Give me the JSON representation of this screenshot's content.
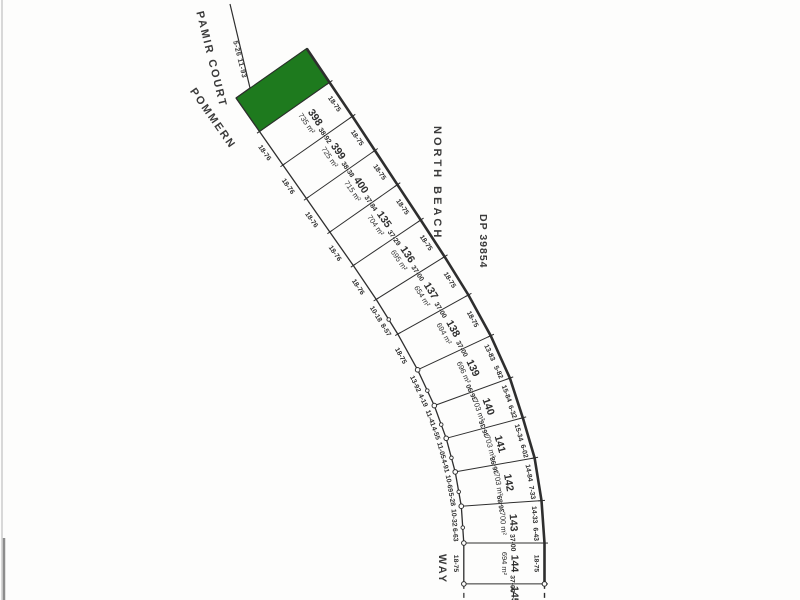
{
  "plan": {
    "description": "Cadastral subdivision plan, curved road frontage with highlighted lot",
    "colors": {
      "highlight_green": "#1e7a1e",
      "ink": "#2e2e2e",
      "scan_edge": "#d8d8d8",
      "scan_mark": "#8c8c8c"
    }
  },
  "streets": {
    "pamir_court": "PAMIR COURT",
    "pamir_dims": "5-26 11-93",
    "pommern": "POMMERN",
    "way": "WAY",
    "north_beach": "NORTH BEACH",
    "dp": "DP 39854"
  },
  "lots": [
    {
      "number": "",
      "area": "",
      "highlight": true,
      "front_m": 18.76,
      "depth_m": 39.6,
      "left_labels": [],
      "right_labels": [],
      "divider_label": "",
      "divider_flip": false
    },
    {
      "number": "398",
      "area": "735 m²",
      "highlight": false,
      "front_m": 18.76,
      "depth_m": 39.25,
      "left_labels": [
        "18-76"
      ],
      "right_labels": [
        "18-75"
      ],
      "divider_label": "38-92",
      "divider_flip": false
    },
    {
      "number": "399",
      "area": "725 m²",
      "highlight": false,
      "front_m": 18.76,
      "depth_m": 38.92,
      "left_labels": [
        "18-76"
      ],
      "right_labels": [
        "18-75"
      ],
      "divider_label": "38-38",
      "divider_flip": false
    },
    {
      "number": "400",
      "area": "715 m²",
      "highlight": false,
      "front_m": 18.76,
      "depth_m": 38.38,
      "left_labels": [
        "18-76"
      ],
      "right_labels": [
        "18-75"
      ],
      "divider_label": "37-84",
      "divider_flip": false
    },
    {
      "number": "135",
      "area": "704 m²",
      "highlight": false,
      "front_m": 18.76,
      "depth_m": 37.84,
      "left_labels": [
        "18-76"
      ],
      "right_labels": [
        "18-75"
      ],
      "divider_label": "37-29",
      "divider_flip": false
    },
    {
      "number": "136",
      "area": "695 m²",
      "highlight": false,
      "front_m": 18.76,
      "depth_m": 37.29,
      "left_labels": [
        "18-76"
      ],
      "right_labels": [
        "18-75"
      ],
      "divider_label": "37-00",
      "divider_flip": false
    },
    {
      "number": "137",
      "area": "654 m²",
      "highlight": false,
      "front_m": 18.75,
      "depth_m": 37.0,
      "left_labels": [
        "10-18",
        "8-57"
      ],
      "right_labels": [
        "18-75"
      ],
      "divider_label": "37-00",
      "divider_flip": false
    },
    {
      "number": "138",
      "area": "694 m²",
      "highlight": false,
      "front_m": 18.75,
      "depth_m": 37.0,
      "left_labels": [
        "18-75"
      ],
      "right_labels": [
        "18-75"
      ],
      "divider_label": "37-00",
      "divider_flip": false
    },
    {
      "number": "139",
      "area": "696 m²",
      "highlight": false,
      "front_m": 18.11,
      "depth_m": 37.0,
      "left_labels": [
        "13-92",
        "4-19"
      ],
      "right_labels": [
        "13-83",
        "5-82"
      ],
      "divider_label": "36-90",
      "divider_flip": true
    },
    {
      "number": "140",
      "area": "703 m²",
      "highlight": false,
      "front_m": 15.96,
      "depth_m": 36.9,
      "left_labels": [
        "11-41",
        "4-55"
      ],
      "right_labels": [
        "15-84",
        "6-32"
      ],
      "divider_label": "36-36",
      "divider_flip": true
    },
    {
      "number": "141",
      "area": "703 m²",
      "highlight": false,
      "front_m": 15.96,
      "depth_m": 36.36,
      "left_labels": [
        "11-05",
        "4-91"
      ],
      "right_labels": [
        "15-34",
        "6-02"
      ],
      "divider_label": "36-98",
      "divider_flip": true
    },
    {
      "number": "142",
      "area": "703 m²",
      "highlight": false,
      "front_m": 15.97,
      "depth_m": 36.98,
      "left_labels": [
        "10-69",
        "5-28"
      ],
      "right_labels": [
        "14-84",
        "7-33"
      ],
      "divider_label": "36-89",
      "divider_flip": true
    },
    {
      "number": "143",
      "area": "700 m²",
      "highlight": false,
      "front_m": 16.95,
      "depth_m": 36.89,
      "left_labels": [
        "10-32",
        "6-63"
      ],
      "right_labels": [
        "14-33",
        "6-43"
      ],
      "divider_label": "37-00",
      "divider_flip": false
    },
    {
      "number": "144",
      "area": "694 m²",
      "highlight": false,
      "front_m": 18.75,
      "depth_m": 37.0,
      "left_labels": [
        "18-75"
      ],
      "right_labels": [
        "18-75"
      ],
      "divider_label": "37-00",
      "divider_flip": false
    },
    {
      "number": "145",
      "area": "",
      "highlight": false,
      "front_m": 10.0,
      "depth_m": 37.0,
      "left_labels": [],
      "right_labels": [],
      "divider_label": "",
      "divider_flip": false
    }
  ]
}
